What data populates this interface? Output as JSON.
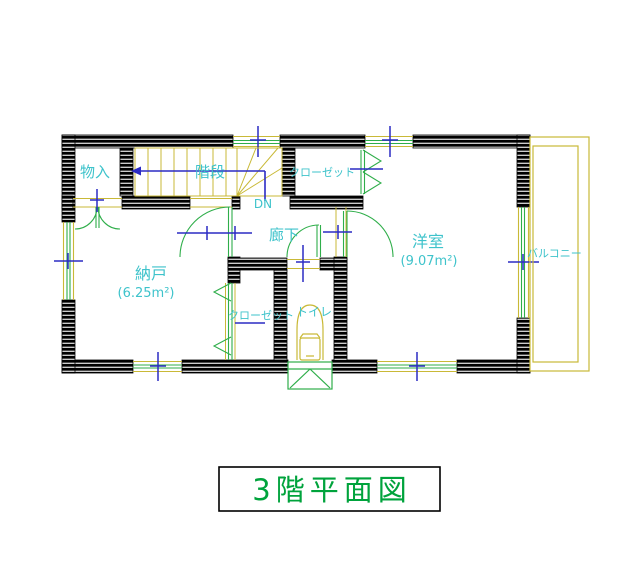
{
  "drawing": {
    "title": "3階平面図",
    "labels": {
      "storage": "物入",
      "stairs": "階段",
      "stairs_direction": "DN",
      "closet_upper": "クローゼット",
      "hallway": "廊下",
      "western_room": "洋室",
      "western_room_area": "(9.07m²)",
      "storeroom": "納戸",
      "storeroom_area": "(6.25m²)",
      "closet_lower": "クローゼット",
      "toilet": "トイレ",
      "balcony": "バルコニー"
    },
    "colors": {
      "background": "#FFFFFF",
      "wall": "#000000",
      "wall_hatch": "#FFFFFF",
      "room_label": "#3EC3CB",
      "title_text": "#00A33C",
      "door_window_green": "#2FAE4A",
      "frame_yellow": "#C9B937",
      "dimension_blue": "#2B2BC4"
    }
  }
}
